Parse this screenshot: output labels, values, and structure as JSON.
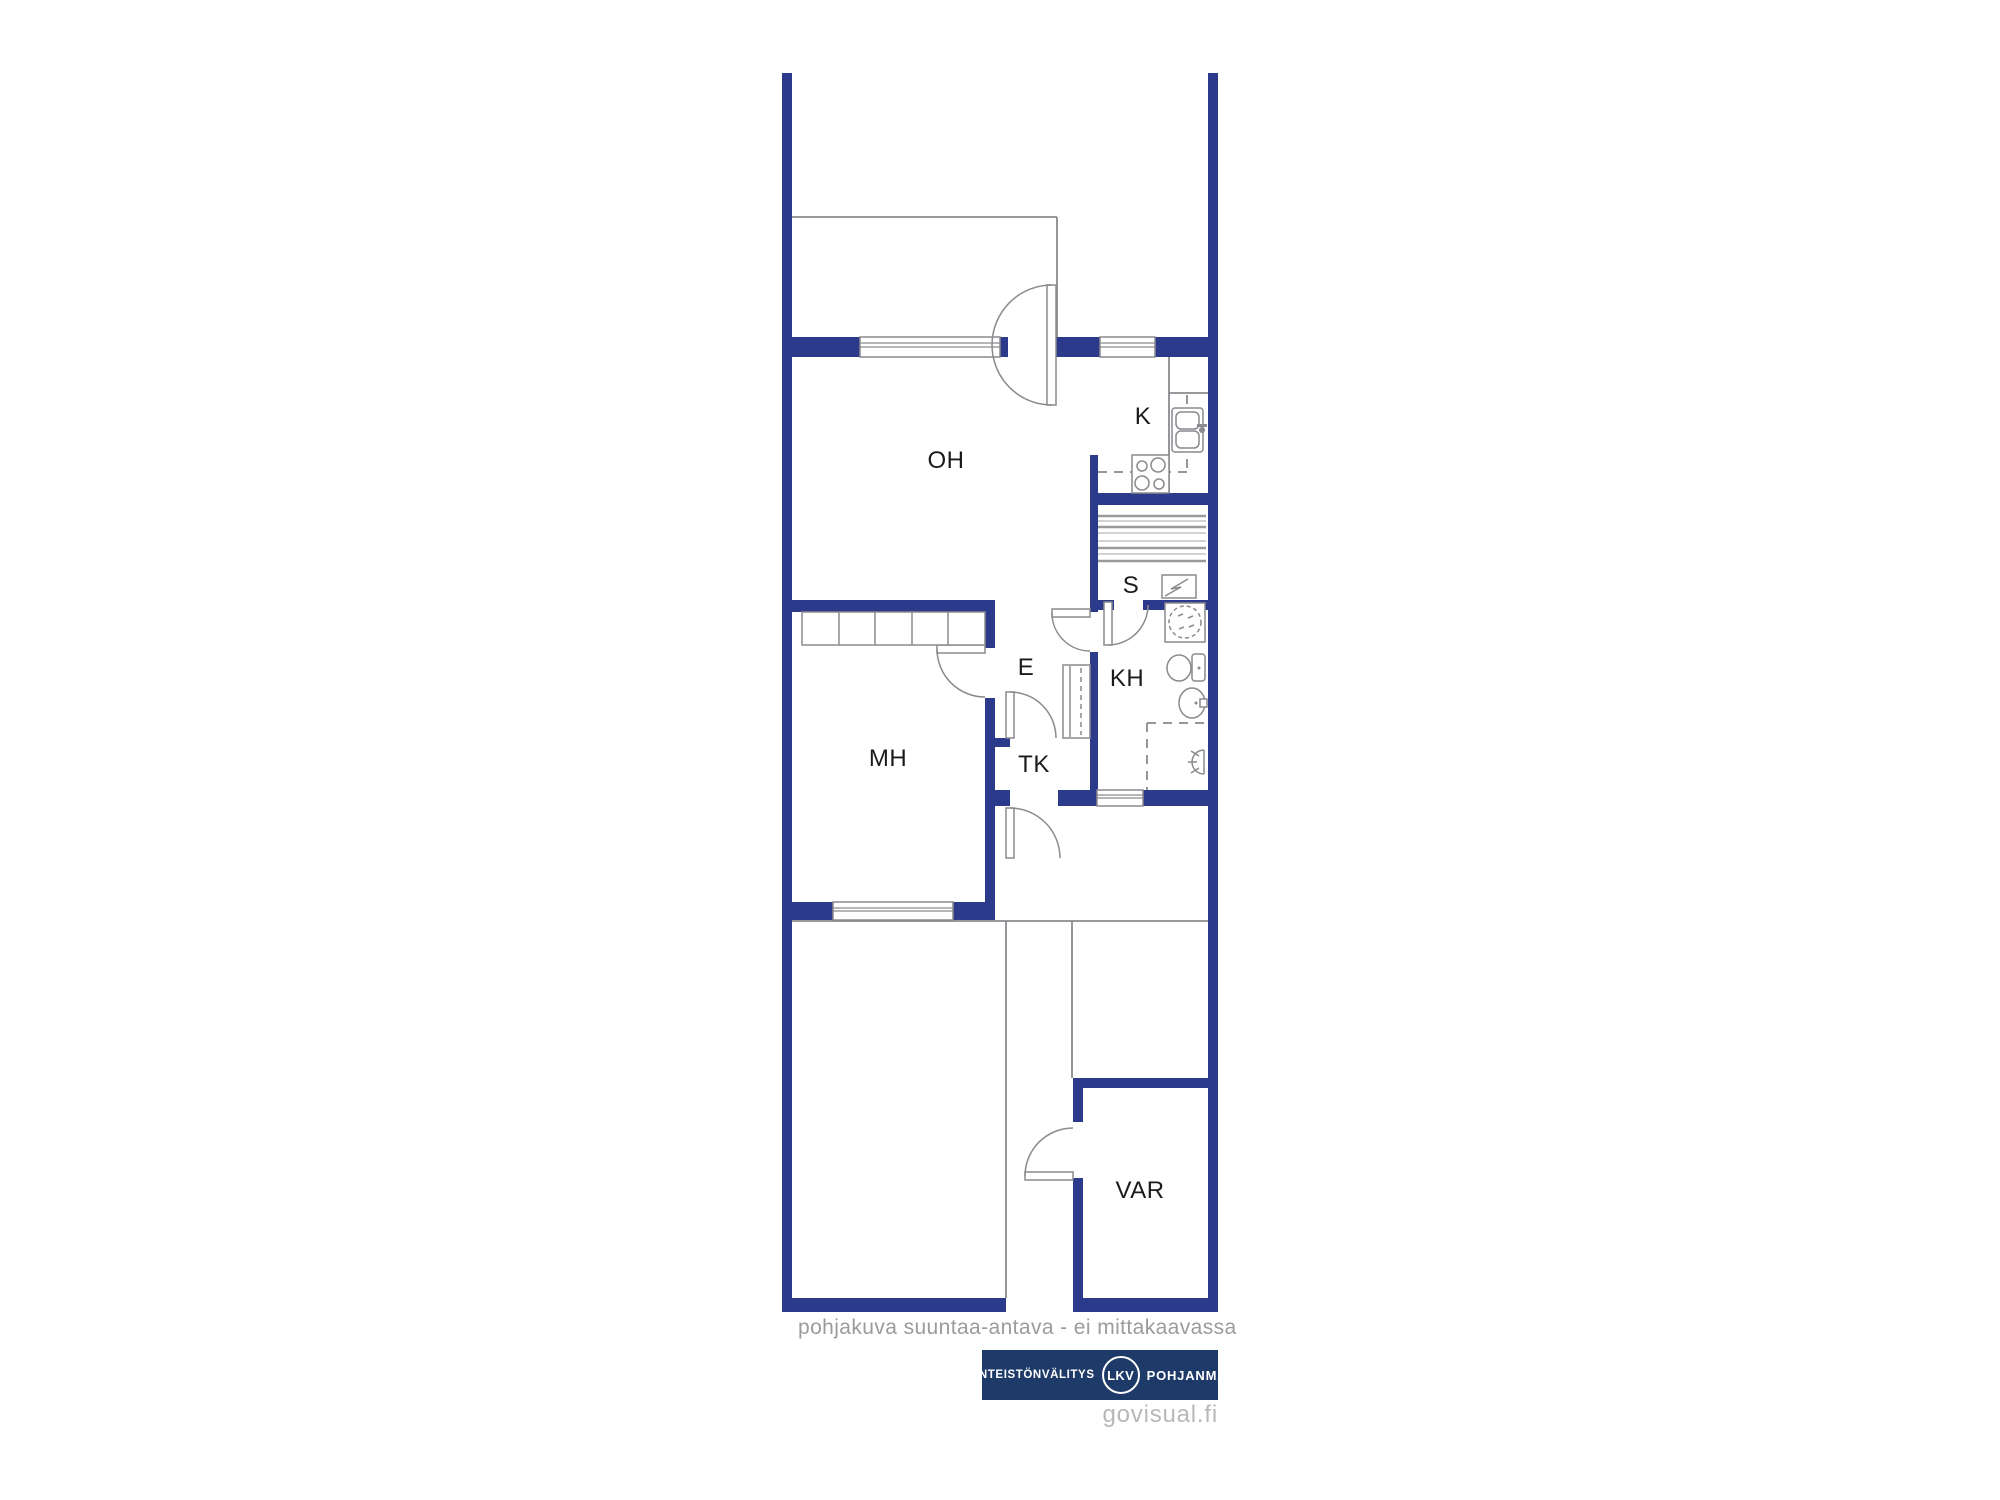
{
  "plan": {
    "rooms": [
      {
        "id": "oh",
        "label": "OH"
      },
      {
        "id": "k",
        "label": "K"
      },
      {
        "id": "s",
        "label": "S"
      },
      {
        "id": "kh",
        "label": "KH"
      },
      {
        "id": "e",
        "label": "E"
      },
      {
        "id": "tk",
        "label": "TK"
      },
      {
        "id": "mh",
        "label": "MH"
      },
      {
        "id": "var",
        "label": "VAR"
      }
    ]
  },
  "footer": {
    "disclaimer": "pohjakuva suuntaa-antava - ei mittakaavassa",
    "watermark": "govisual.fi"
  },
  "logo": {
    "left": "KIINTEISTÖNVÄLITYS",
    "badge": "LKV",
    "right": "POHJANMAA"
  },
  "colors": {
    "wall": "#2b3a8a",
    "line": "#8a8a8f",
    "label": "#1b1b1b",
    "muted": "#9b9b9d",
    "watermark": "#b8b8ba",
    "logo_bg": "#1d3a68"
  }
}
